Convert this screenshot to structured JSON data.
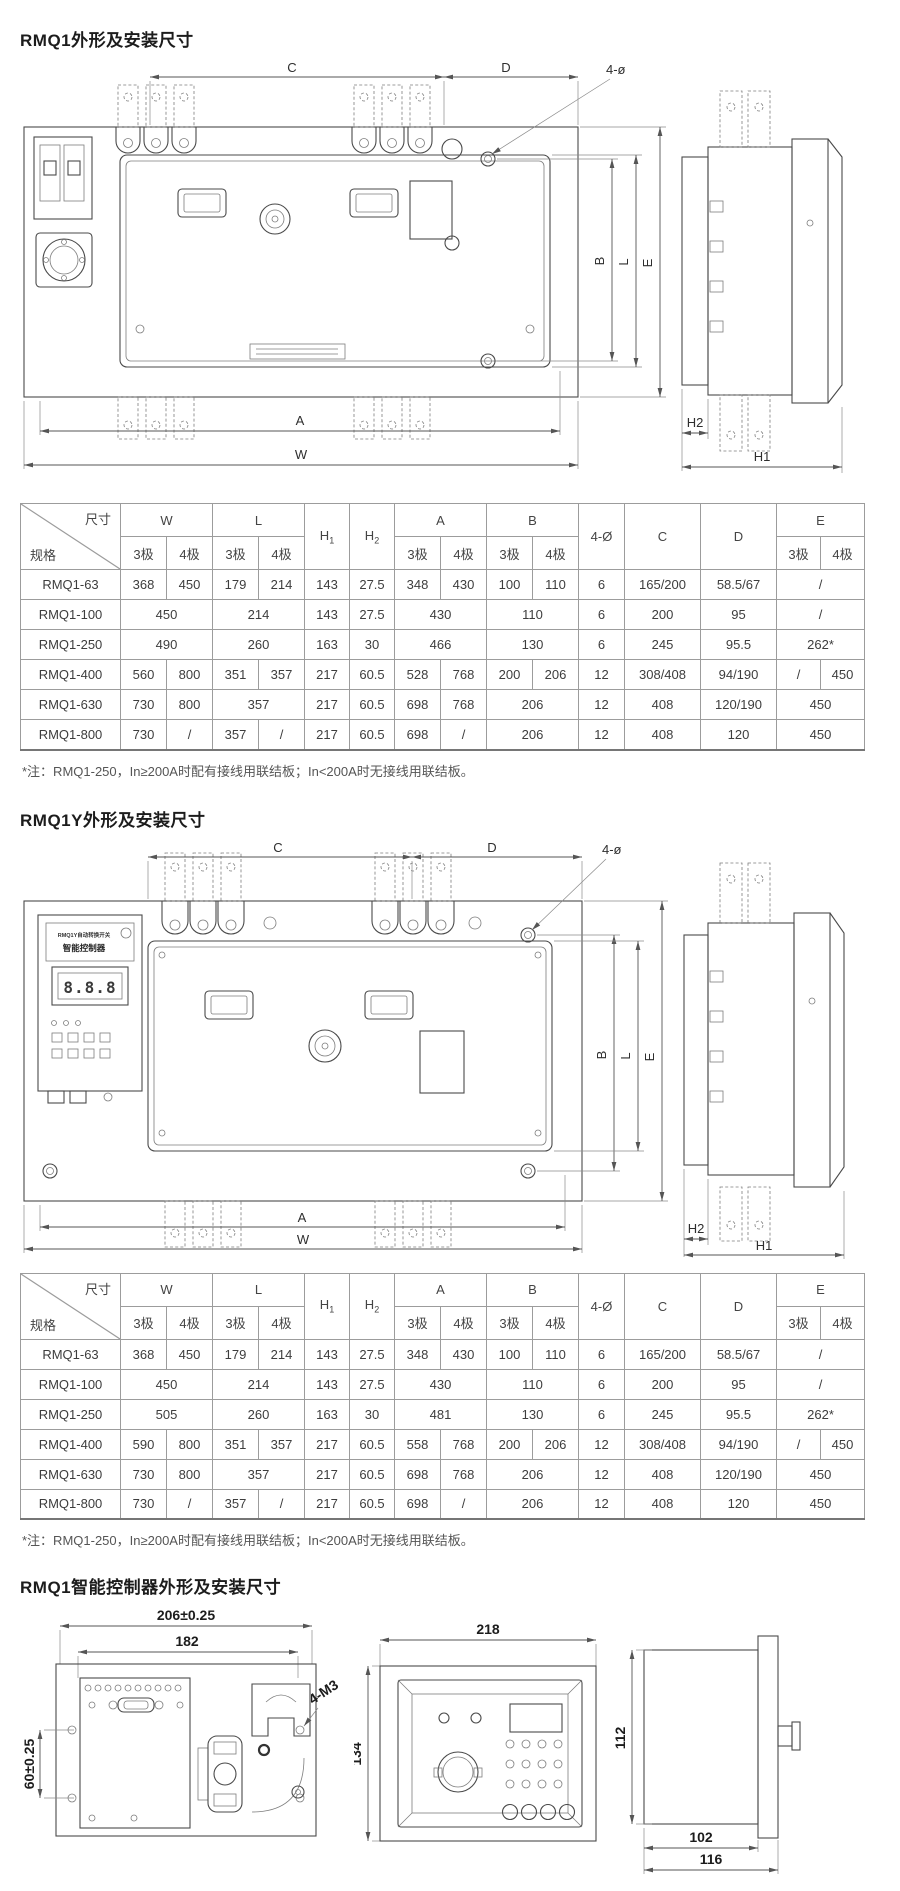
{
  "page": {
    "bg": "#ffffff",
    "line_color": "#4a4a4a",
    "accent_text": "#1c1c1c"
  },
  "sections": [
    {
      "title": "RMQ1外形及安装尺寸",
      "note": "*注：RMQ1-250，In≥200A时配有接线用联结板；In<200A时无接线用联结板。"
    },
    {
      "title": "RMQ1Y外形及安装尺寸",
      "note": "*注：RMQ1-250，In≥200A时配有接线用联结板；In<200A时无接线用联结板。"
    },
    {
      "title": "RMQ1智能控制器外形及安装尺寸"
    }
  ],
  "dim_labels": {
    "c": "C",
    "d": "D",
    "hole": "4-ø",
    "b": "B",
    "l": "L",
    "e": "E",
    "a": "A",
    "w": "W",
    "h1": "H1",
    "h2": "H2"
  },
  "controller_panel": {
    "line1": "RMQ1Y自动转换开关",
    "line2": "智能控制器",
    "display": "8.8.8"
  },
  "controller_dims": {
    "back_width_outer": "206±0.25",
    "back_width_inner": "182",
    "back_height": "60±0.25",
    "screws": "4-M3",
    "front_width": "218",
    "front_height": "134",
    "side_height": "112",
    "side_depth_inner": "102",
    "side_depth_outer": "116"
  },
  "table_header": {
    "corner_top": "尺寸",
    "corner_bottom": "规格",
    "poles": [
      "3极",
      "4极"
    ],
    "cols": [
      {
        "label": "W",
        "split": true
      },
      {
        "label": "L",
        "split": true
      },
      {
        "label": "H",
        "sub": "1"
      },
      {
        "label": "H",
        "sub": "2"
      },
      {
        "label": "A",
        "split": true
      },
      {
        "label": "B",
        "split": true
      },
      {
        "label": "4-Ø"
      },
      {
        "label": "C"
      },
      {
        "label": "D"
      },
      {
        "label": "E",
        "split": true
      }
    ]
  },
  "tables": [
    {
      "rows": [
        {
          "model": "RMQ1-63",
          "cells": [
            [
              "368",
              1
            ],
            [
              "450",
              1
            ],
            [
              "179",
              1
            ],
            [
              "214",
              1
            ],
            [
              "143",
              1
            ],
            [
              "27.5",
              1
            ],
            [
              "348",
              1
            ],
            [
              "430",
              1
            ],
            [
              "100",
              1
            ],
            [
              "110",
              1
            ],
            [
              "6",
              1
            ],
            [
              "165/200",
              1
            ],
            [
              "58.5/67",
              1
            ],
            [
              "/",
              2
            ]
          ]
        },
        {
          "model": "RMQ1-100",
          "cells": [
            [
              "450",
              2
            ],
            [
              "214",
              2
            ],
            [
              "143",
              1
            ],
            [
              "27.5",
              1
            ],
            [
              "430",
              2
            ],
            [
              "110",
              2
            ],
            [
              "6",
              1
            ],
            [
              "200",
              1
            ],
            [
              "95",
              1
            ],
            [
              "/",
              2
            ]
          ]
        },
        {
          "model": "RMQ1-250",
          "cells": [
            [
              "490",
              2
            ],
            [
              "260",
              2
            ],
            [
              "163",
              1
            ],
            [
              "30",
              1
            ],
            [
              "466",
              2
            ],
            [
              "130",
              2
            ],
            [
              "6",
              1
            ],
            [
              "245",
              1
            ],
            [
              "95.5",
              1
            ],
            [
              "262*",
              2
            ]
          ]
        },
        {
          "model": "RMQ1-400",
          "cells": [
            [
              "560",
              1
            ],
            [
              "800",
              1
            ],
            [
              "351",
              1
            ],
            [
              "357",
              1
            ],
            [
              "217",
              1
            ],
            [
              "60.5",
              1
            ],
            [
              "528",
              1
            ],
            [
              "768",
              1
            ],
            [
              "200",
              1
            ],
            [
              "206",
              1
            ],
            [
              "12",
              1
            ],
            [
              "308/408",
              1
            ],
            [
              "94/190",
              1
            ],
            [
              "/",
              1
            ],
            [
              "450",
              1
            ]
          ]
        },
        {
          "model": "RMQ1-630",
          "cells": [
            [
              "730",
              1
            ],
            [
              "800",
              1
            ],
            [
              "357",
              2
            ],
            [
              "217",
              1
            ],
            [
              "60.5",
              1
            ],
            [
              "698",
              1
            ],
            [
              "768",
              1
            ],
            [
              "206",
              2
            ],
            [
              "12",
              1
            ],
            [
              "408",
              1
            ],
            [
              "120/190",
              1
            ],
            [
              "450",
              2
            ]
          ]
        },
        {
          "model": "RMQ1-800",
          "cells": [
            [
              "730",
              1
            ],
            [
              "/",
              1
            ],
            [
              "357",
              1
            ],
            [
              "/",
              1
            ],
            [
              "217",
              1
            ],
            [
              "60.5",
              1
            ],
            [
              "698",
              1
            ],
            [
              "/",
              1
            ],
            [
              "206",
              2
            ],
            [
              "12",
              1
            ],
            [
              "408",
              1
            ],
            [
              "120",
              1
            ],
            [
              "450",
              2
            ]
          ]
        }
      ]
    },
    {
      "rows": [
        {
          "model": "RMQ1-63",
          "cells": [
            [
              "368",
              1
            ],
            [
              "450",
              1
            ],
            [
              "179",
              1
            ],
            [
              "214",
              1
            ],
            [
              "143",
              1
            ],
            [
              "27.5",
              1
            ],
            [
              "348",
              1
            ],
            [
              "430",
              1
            ],
            [
              "100",
              1
            ],
            [
              "110",
              1
            ],
            [
              "6",
              1
            ],
            [
              "165/200",
              1
            ],
            [
              "58.5/67",
              1
            ],
            [
              "/",
              2
            ]
          ]
        },
        {
          "model": "RMQ1-100",
          "cells": [
            [
              "450",
              2
            ],
            [
              "214",
              2
            ],
            [
              "143",
              1
            ],
            [
              "27.5",
              1
            ],
            [
              "430",
              2
            ],
            [
              "110",
              2
            ],
            [
              "6",
              1
            ],
            [
              "200",
              1
            ],
            [
              "95",
              1
            ],
            [
              "/",
              2
            ]
          ]
        },
        {
          "model": "RMQ1-250",
          "cells": [
            [
              "505",
              2
            ],
            [
              "260",
              2
            ],
            [
              "163",
              1
            ],
            [
              "30",
              1
            ],
            [
              "481",
              2
            ],
            [
              "130",
              2
            ],
            [
              "6",
              1
            ],
            [
              "245",
              1
            ],
            [
              "95.5",
              1
            ],
            [
              "262*",
              2
            ]
          ]
        },
        {
          "model": "RMQ1-400",
          "cells": [
            [
              "590",
              1
            ],
            [
              "800",
              1
            ],
            [
              "351",
              1
            ],
            [
              "357",
              1
            ],
            [
              "217",
              1
            ],
            [
              "60.5",
              1
            ],
            [
              "558",
              1
            ],
            [
              "768",
              1
            ],
            [
              "200",
              1
            ],
            [
              "206",
              1
            ],
            [
              "12",
              1
            ],
            [
              "308/408",
              1
            ],
            [
              "94/190",
              1
            ],
            [
              "/",
              1
            ],
            [
              "450",
              1
            ]
          ]
        },
        {
          "model": "RMQ1-630",
          "cells": [
            [
              "730",
              1
            ],
            [
              "800",
              1
            ],
            [
              "357",
              2
            ],
            [
              "217",
              1
            ],
            [
              "60.5",
              1
            ],
            [
              "698",
              1
            ],
            [
              "768",
              1
            ],
            [
              "206",
              2
            ],
            [
              "12",
              1
            ],
            [
              "408",
              1
            ],
            [
              "120/190",
              1
            ],
            [
              "450",
              2
            ]
          ]
        },
        {
          "model": "RMQ1-800",
          "cells": [
            [
              "730",
              1
            ],
            [
              "/",
              1
            ],
            [
              "357",
              1
            ],
            [
              "/",
              1
            ],
            [
              "217",
              1
            ],
            [
              "60.5",
              1
            ],
            [
              "698",
              1
            ],
            [
              "/",
              1
            ],
            [
              "206",
              2
            ],
            [
              "12",
              1
            ],
            [
              "408",
              1
            ],
            [
              "120",
              1
            ],
            [
              "450",
              2
            ]
          ]
        }
      ]
    }
  ]
}
